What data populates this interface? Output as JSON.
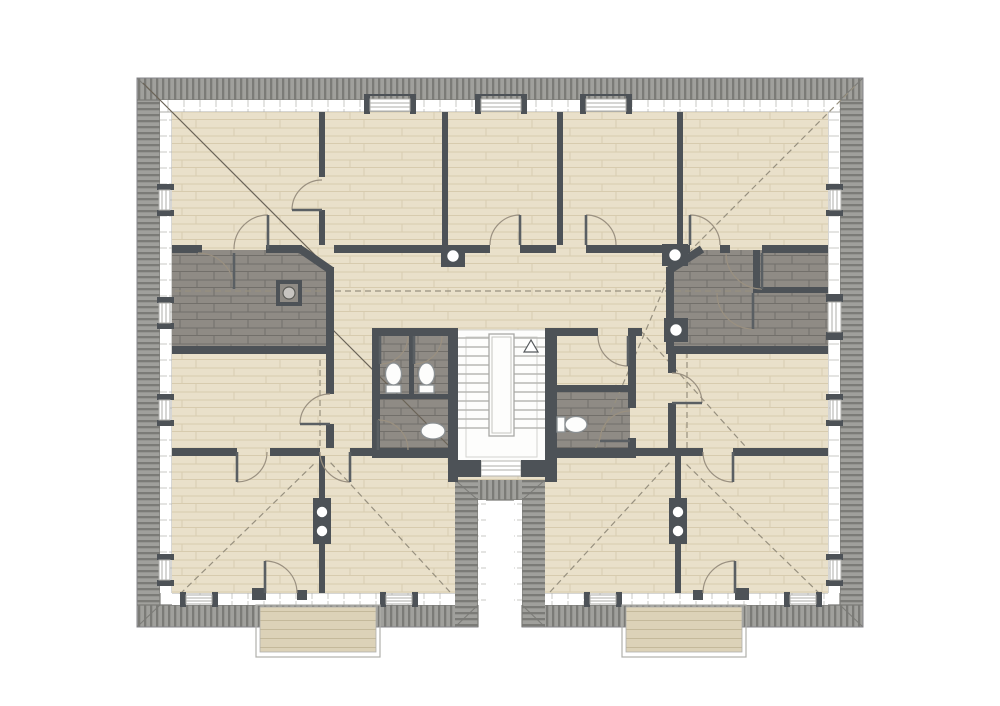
{
  "document": {
    "type": "architectural-floor-plan",
    "storey": "attic",
    "visible_text": "none"
  },
  "canvas": {
    "width": 1000,
    "height": 706
  },
  "colors": {
    "page_bg": "#ffffff",
    "roof_base": "#a0a09c",
    "roof_stripe": "#7b7b77",
    "outline": "#85858a",
    "band_line": "#aeaeaa",
    "tick": "#c9c9c5",
    "wood_base": "#e9e0ca",
    "wood_line": "#d7cbae",
    "brick_base": "#8f8b85",
    "brick_line": "#726f6a",
    "wall": "#4d5257",
    "stair_bg": "#fdfdfc",
    "step_line": "#b8b8b4",
    "door_arc": "#9a9080",
    "door_leaf": "#5a5f63",
    "dash_line": "#97907f",
    "hip_line": "#6b6458",
    "deck_base": "#dcd2b8",
    "deck_line": "#c4b99b",
    "fixture_stroke": "#8a8f92"
  },
  "inventory": {
    "roof_band": "hatched perimeter with mitered corners and U-shaped courtyard notch at bottom center",
    "rooms_wood_floor": 12,
    "dark_brick_areas": [
      "terrace-left",
      "terrace-right",
      "wc-block-left",
      "wc-block-right"
    ],
    "staircase": {
      "count": 1,
      "direction_arrow": "up",
      "location": "center"
    },
    "toilets": 3,
    "sinks": 1,
    "chimneys": 3,
    "columns": 3,
    "balconies": 2,
    "dormer_windows_top": 3,
    "side_windows": 8,
    "bottom_windows": 4,
    "door_swings": 18,
    "dashed_lines": "roof ridge and hip projection lines"
  }
}
